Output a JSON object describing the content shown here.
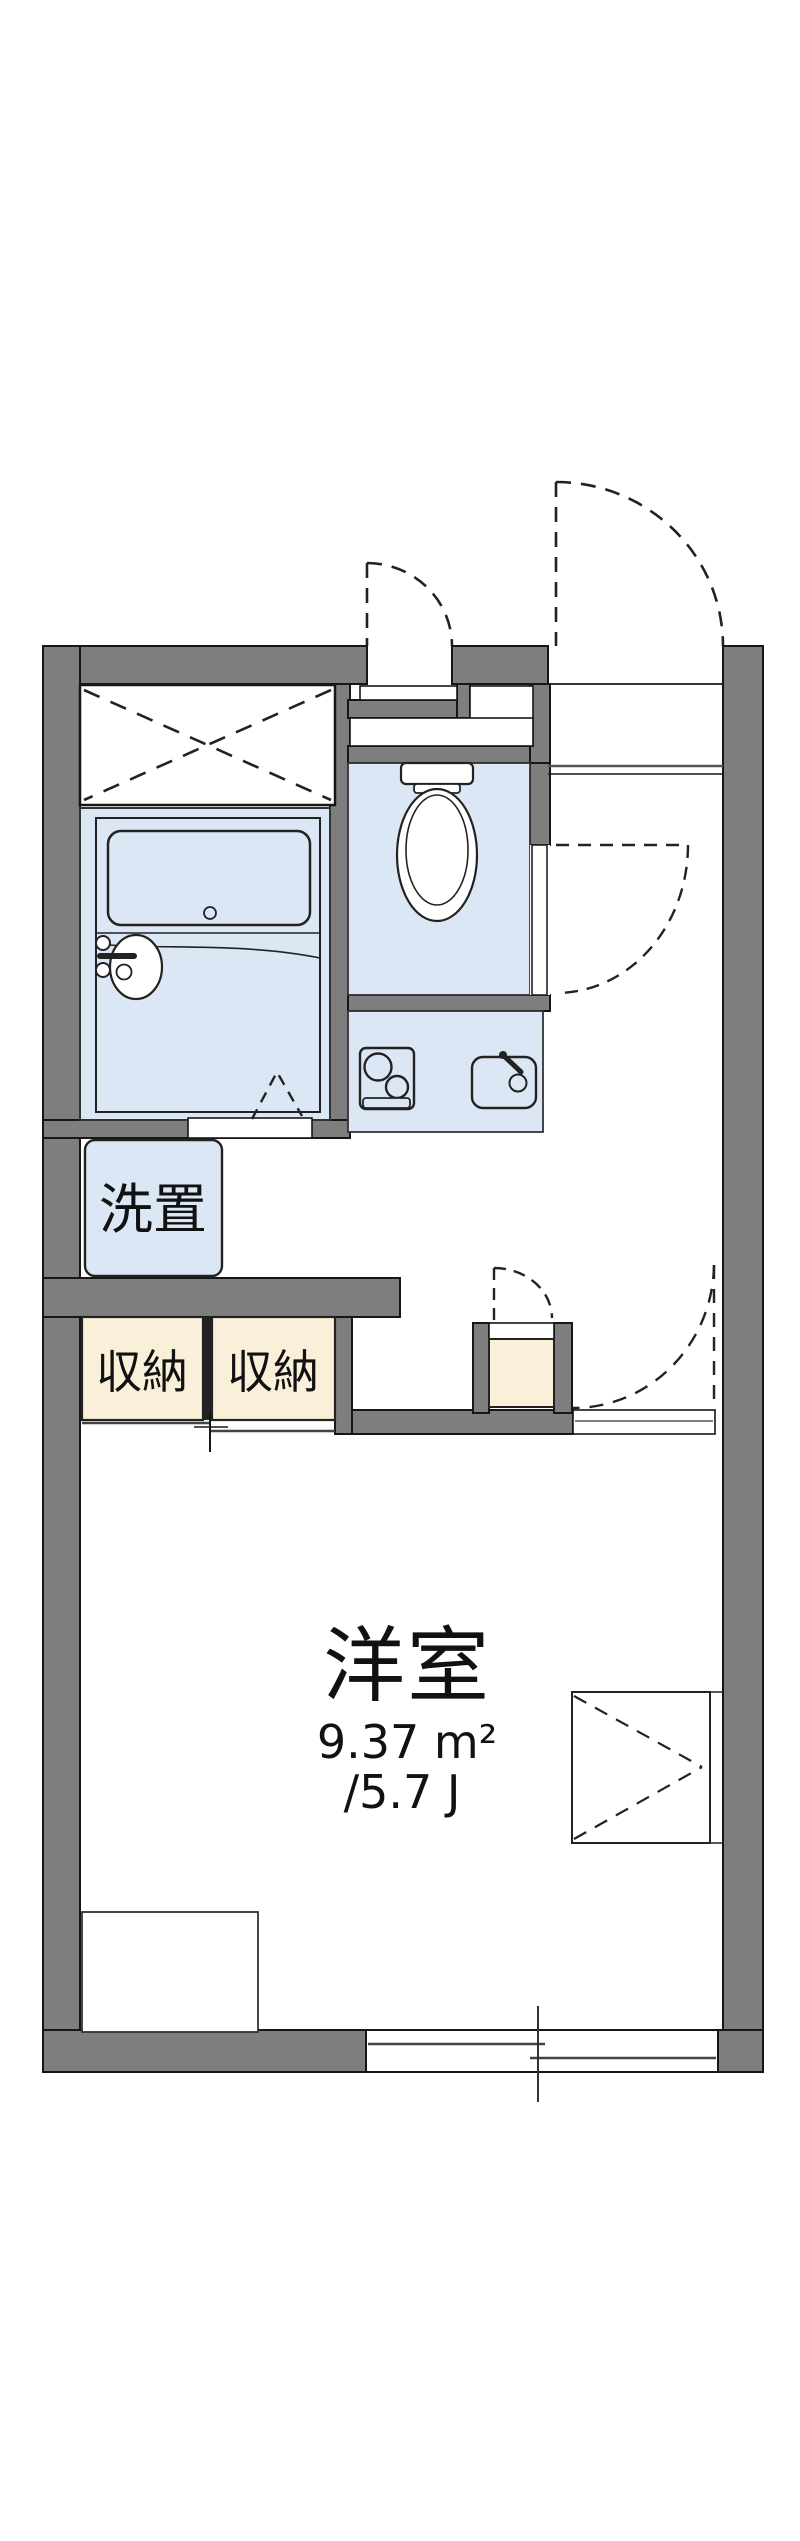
{
  "floorplan": {
    "labels": {
      "main_room": "洋室",
      "main_room_area_m2": "9.37 m²",
      "main_room_area_jo": "/5.7 J",
      "storage_left": "収納",
      "storage_right": "収納",
      "washer_place": "洗置"
    },
    "colors": {
      "wall": "#7E7E7E",
      "outline": "#161616",
      "wet_area_fill": "#DCE7F5",
      "storage_fill": "#FAF0D9",
      "background": "#FFFFFF"
    }
  }
}
